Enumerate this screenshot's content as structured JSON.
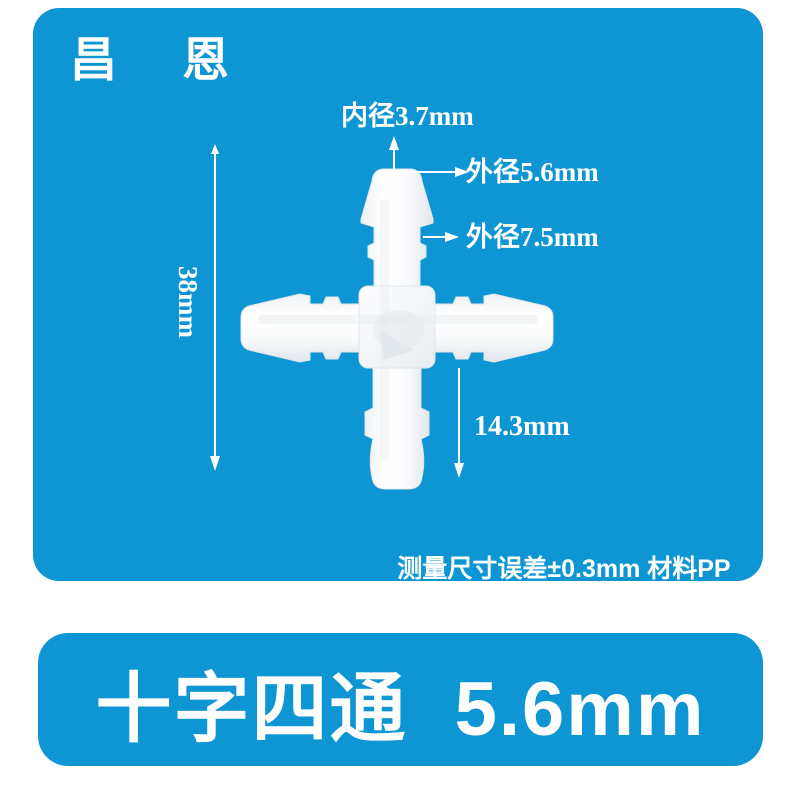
{
  "colors": {
    "panel_blue": "#0e96d4",
    "text_white": "#ffffff",
    "page_bg": "#ffffff"
  },
  "brand": {
    "name": "昌 恩"
  },
  "diagram": {
    "inner_diameter": "内径3.7mm",
    "outer_diameter_small": "外径5.6mm",
    "outer_diameter_large": "外径7.5mm",
    "overall_length": "38mm",
    "port_length": "14.3mm",
    "note": "测量尺寸误差±0.3mm  材料PP"
  },
  "footer": {
    "product_title": "十字四通 5.6mm"
  }
}
